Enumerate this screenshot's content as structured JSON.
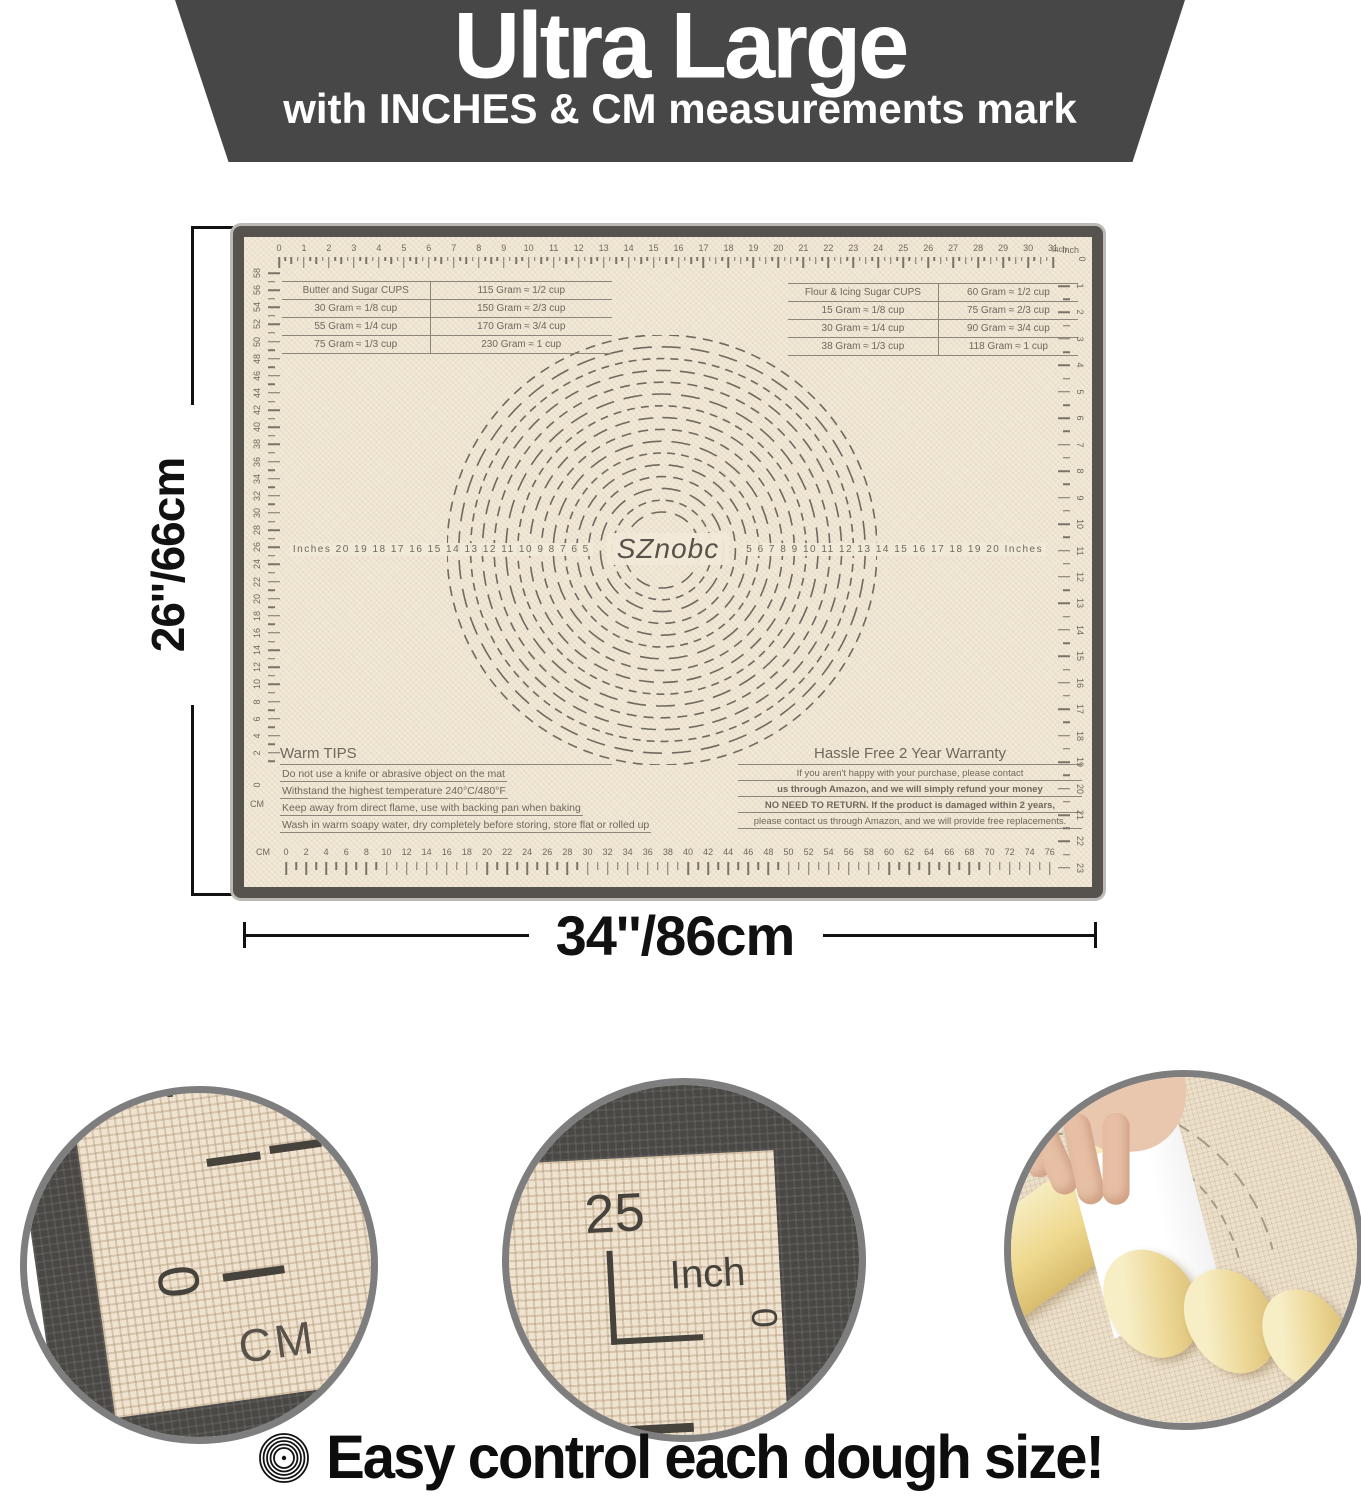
{
  "colors": {
    "banner_bg": "#474747",
    "banner_text": "#ffffff",
    "mat_surface": "#f1e9d8",
    "mat_border": "#56534e",
    "marking": "#6f685d",
    "dimension_text": "#111111",
    "caption_text": "#0d0d0d",
    "dough": "#ecd795"
  },
  "banner": {
    "title": "Ultra Large",
    "subtitle": "with INCHES & CM measurements mark"
  },
  "dimensions": {
    "height_label": "26''/66cm",
    "width_label": "34''/86cm"
  },
  "mat": {
    "brand": "SZnobc",
    "top_ruler": {
      "unit": "Inch",
      "numbers": [
        0,
        1,
        2,
        3,
        4,
        5,
        6,
        7,
        8,
        9,
        10,
        11,
        12,
        13,
        14,
        15,
        16,
        17,
        18,
        19,
        20,
        21,
        22,
        23,
        24,
        25,
        26,
        27,
        28,
        29,
        30,
        31
      ]
    },
    "bottom_ruler": {
      "unit": "CM",
      "numbers": [
        0,
        2,
        4,
        6,
        8,
        10,
        12,
        14,
        16,
        18,
        20,
        22,
        24,
        26,
        28,
        30,
        32,
        34,
        36,
        38,
        40,
        42,
        44,
        46,
        48,
        50,
        52,
        54,
        56,
        58,
        60,
        62,
        64,
        66,
        68,
        70,
        72,
        74,
        76
      ]
    },
    "left_ruler": {
      "unit": "CM",
      "numbers": [
        58,
        56,
        54,
        52,
        50,
        48,
        46,
        44,
        42,
        40,
        38,
        36,
        34,
        32,
        30,
        28,
        26,
        24,
        22,
        20,
        18,
        16,
        14,
        12,
        10,
        8,
        6,
        4,
        2
      ],
      "corner_labels": [
        "0",
        "CM"
      ]
    },
    "right_ruler": {
      "unit": "Inch",
      "corner_labels": [
        "Inch",
        "0"
      ],
      "numbers": [
        1,
        2,
        3,
        4,
        5,
        6,
        7,
        8,
        9,
        10,
        11,
        12,
        13,
        14,
        15,
        16,
        17,
        18,
        19,
        20,
        21,
        22,
        23
      ]
    },
    "butter_table": {
      "rows": [
        [
          "Butter and Sugar CUPS",
          "115 Gram ≈ 1/2 cup"
        ],
        [
          "30 Gram ≈ 1/8 cup",
          "150 Gram ≈ 2/3 cup"
        ],
        [
          "55 Gram ≈ 1/4 cup",
          "170 Gram ≈ 3/4 cup"
        ],
        [
          "75 Gram ≈ 1/3 cup",
          "230 Gram ≈ 1 cup"
        ]
      ]
    },
    "flour_table": {
      "rows": [
        [
          "Flour & Icing Sugar CUPS",
          "60 Gram ≈ 1/2 cup"
        ],
        [
          "15 Gram ≈ 1/8 cup",
          "75 Gram ≈ 2/3 cup"
        ],
        [
          "30 Gram ≈ 1/4 cup",
          "90 Gram ≈ 3/4 cup"
        ],
        [
          "38 Gram ≈ 1/3 cup",
          "118 Gram ≈ 1 cup"
        ]
      ]
    },
    "center_scale": {
      "left": "Inches  20 19 18 17 16 15 14 13 12 11 10 9 8 7 6 5",
      "right": "5 6 7 8 9 10 11 12 13 14 15 16 17 18 19 20  Inches"
    },
    "dashed_circles": {
      "count": 16,
      "diameter_range_inches": [
        5,
        20
      ]
    },
    "warm_tips": {
      "title": "Warm TIPS",
      "lines": [
        "Do not use a knife or abrasive object on the mat",
        "Withstand the highest temperature 240°C/480°F",
        "Keep away from direct flame, use with backing pan when baking",
        "Wash in warm soapy water, dry completely before storing, store flat or rolled up"
      ]
    },
    "warranty": {
      "title": "Hassle Free 2 Year Warranty",
      "lines": [
        "If you aren't happy with your purchase, please contact",
        "us through Amazon,  and we will simply refund your money",
        "NO NEED TO RETURN. If the product is damaged within 2 years,",
        "please contact us through Amazon, and we will provide free replacements."
      ]
    }
  },
  "closeups": {
    "cm_corner": {
      "two": "2",
      "zero_side": "0",
      "unit": "CM",
      "zero_big": "0"
    },
    "inch_corner": {
      "value": "25",
      "unit": "Inch",
      "zero": "0"
    },
    "photo": {
      "edge_numbers": [
        "32",
        "34",
        "36",
        "38",
        "40",
        "42",
        "44"
      ],
      "side_numbers": [
        "6",
        "5",
        "4",
        "3",
        "2"
      ],
      "unit": "Inches"
    }
  },
  "caption": {
    "icon": "concentric-circles",
    "text": "Easy control each dough size!"
  }
}
